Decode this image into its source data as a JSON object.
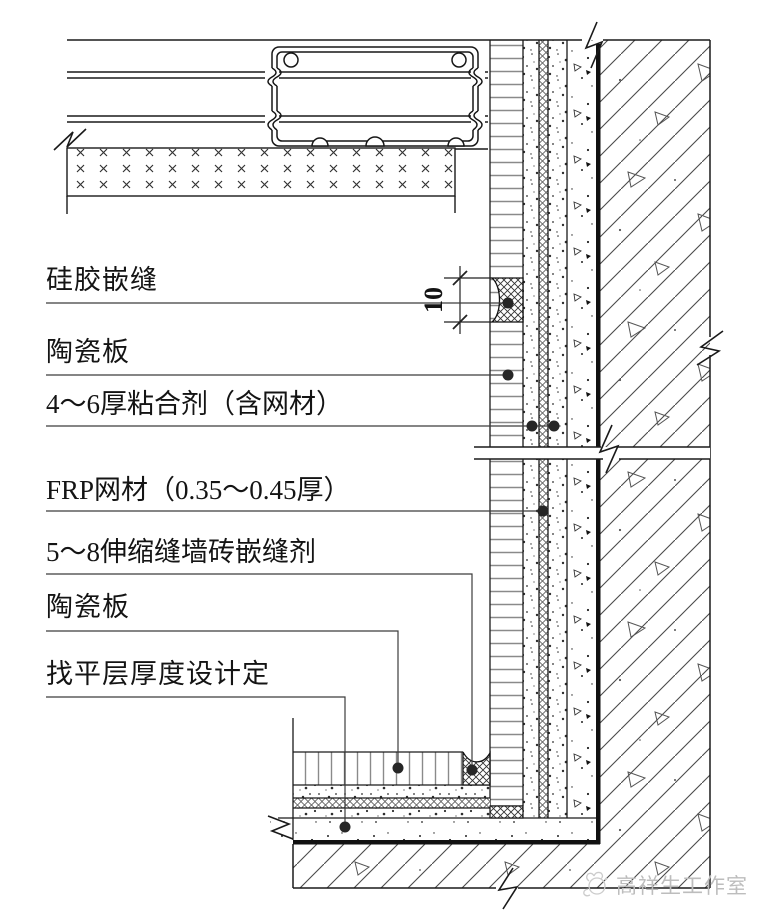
{
  "drawing": {
    "type": "construction-detail-section",
    "labels": [
      {
        "id": "silicone-caulk",
        "text": "硅胶嵌缝"
      },
      {
        "id": "ceramic-panel-wall",
        "text": "陶瓷板"
      },
      {
        "id": "adhesive-with-mesh",
        "text": "4～6厚粘合剂（含网材）"
      },
      {
        "id": "frp-mesh",
        "text": "FRP网材（0.35～0.45厚）"
      },
      {
        "id": "expansion-joint-sealant",
        "text": "5～8伸缩缝墙砖嵌缝剂"
      },
      {
        "id": "ceramic-panel-floor",
        "text": "陶瓷板"
      },
      {
        "id": "leveling-layer",
        "text": "找平层厚度设计定"
      }
    ],
    "dimension": {
      "value": "10"
    },
    "watermark": {
      "text": "高祥生工作室",
      "icon": "studio-logo-icon"
    },
    "colors": {
      "background": "#ffffff",
      "line": "#1a1a1a",
      "hatch": "#4a4a4a",
      "rung": "#8a8a8a",
      "leader": "#3c3c3c",
      "watermark": "#bdbdbd"
    }
  }
}
